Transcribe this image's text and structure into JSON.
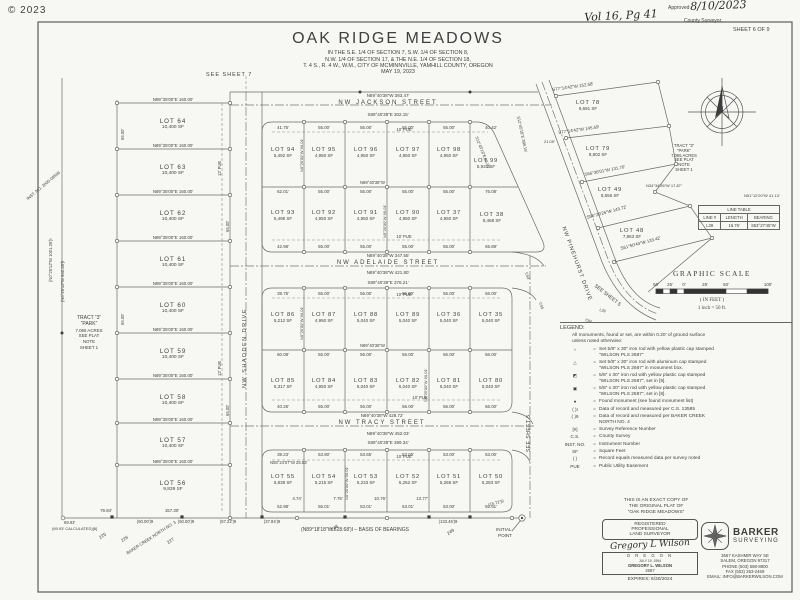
{
  "page": {
    "copyright": "© 2023",
    "sheet": "SHEET 6 OF 9"
  },
  "hand": {
    "vol": "Vol 16, Pg 41",
    "approved_label": "Approved",
    "date": "8/10/2023",
    "county": "County Surveyor"
  },
  "title_block": {
    "title": "OAK RIDGE MEADOWS",
    "l1": "IN THE S.E. 1/4 OF SECTION 7, S.W. 1/4 OF SECTION 8,",
    "l2": "N.W. 1/4 OF SECTION 17, & THE N.E. 1/4 OF SECTION 18,",
    "l3": "T. 4 S., R. 4 W., W.M., CITY OF MCMINNVILLE, YAMHILL  COUNTY, OREGON",
    "l4": "MAY 19, 2023"
  },
  "refs": {
    "sheet7": "SEE SHEET 7",
    "sheet5a": "SEE SHEET 5",
    "sheet5b": "SEE SHEET 5",
    "initial1": "INITIAL",
    "initial2": "POINT",
    "north_n": "N"
  },
  "streets": {
    "jackson": "NW JACKSON STREET",
    "adelaide": "NW ADELAIDE STREET",
    "tracy": "NW TRACY STREET",
    "shadden": "NW SHADDEN DRIVE",
    "pinehurst": "NW PINEHURST DRIVE"
  },
  "lots": [
    {
      "name": "LOT 64",
      "sf": "10,400 SF"
    },
    {
      "name": "LOT 63",
      "sf": "10,400 SF"
    },
    {
      "name": "LOT 62",
      "sf": "10,400 SF"
    },
    {
      "name": "LOT 61",
      "sf": "10,400 SF"
    },
    {
      "name": "LOT 60",
      "sf": "10,400 SF"
    },
    {
      "name": "LOT 59",
      "sf": "10,400 SF"
    },
    {
      "name": "LOT 58",
      "sf": "10,400 SF"
    },
    {
      "name": "LOT 57",
      "sf": "10,400 SF"
    },
    {
      "name": "LOT 56",
      "sf": "9,839 SF"
    },
    {
      "name": "LOT 94",
      "sf": "5,492 SF"
    },
    {
      "name": "LOT 95",
      "sf": "4,950 SF"
    },
    {
      "name": "LOT 96",
      "sf": "4,950 SF"
    },
    {
      "name": "LOT 97",
      "sf": "4,950 SF"
    },
    {
      "name": "LOT 98",
      "sf": "4,950 SF"
    },
    {
      "name": "LOT 99",
      "sf": "5,931 SF"
    },
    {
      "name": "LOT 93",
      "sf": "5,498 SF"
    },
    {
      "name": "LOT 92",
      "sf": "4,950 SF"
    },
    {
      "name": "LOT 91",
      "sf": "4,950 SF"
    },
    {
      "name": "LOT 90",
      "sf": "4,950 SF"
    },
    {
      "name": "LOT 37",
      "sf": "4,950 SF"
    },
    {
      "name": "LOT 38",
      "sf": "8,468 SF"
    },
    {
      "name": "LOT 86",
      "sf": "5,212 SF"
    },
    {
      "name": "LOT 87",
      "sf": "4,950 SF"
    },
    {
      "name": "LOT 88",
      "sf": "5,040 SF"
    },
    {
      "name": "LOT 89",
      "sf": "5,040 SF"
    },
    {
      "name": "LOT 36",
      "sf": "5,040 SF"
    },
    {
      "name": "LOT 35",
      "sf": "5,040 SF"
    },
    {
      "name": "LOT 85",
      "sf": "5,317 SF"
    },
    {
      "name": "LOT 84",
      "sf": "4,950 SF"
    },
    {
      "name": "LOT 83",
      "sf": "5,040 SF"
    },
    {
      "name": "LOT 82",
      "sf": "5,040 SF"
    },
    {
      "name": "LOT 81",
      "sf": "5,040 SF"
    },
    {
      "name": "LOT 80",
      "sf": "5,040 SF"
    },
    {
      "name": "LOT 55",
      "sf": "5,838 SF"
    },
    {
      "name": "LOT 54",
      "sf": "5,215 SF"
    },
    {
      "name": "LOT 53",
      "sf": "5,233 SF"
    },
    {
      "name": "LOT 52",
      "sf": "5,252 SF"
    },
    {
      "name": "LOT 51",
      "sf": "5,269 SF"
    },
    {
      "name": "LOT 50",
      "sf": "5,283 SF"
    },
    {
      "name": "LOT 78",
      "sf": "9,691 SF"
    },
    {
      "name": "LOT 79",
      "sf": "8,802 SF"
    },
    {
      "name": "LOT 49",
      "sf": "8,556 SF"
    },
    {
      "name": "LOT 48",
      "sf": "7,863 SF"
    }
  ],
  "tract": {
    "t1": "TRACT “3”",
    "t2": "“PARK”",
    "t3": "7.065 ACRES",
    "t4": "SEE PLAT",
    "t5": "NOTE",
    "t6": "SHEET 1"
  },
  "bearings": {
    "jackson_out": "N89°40′38″W 383.47′",
    "jackson_in": "S89°40′38″E 302.15′",
    "adelaide_out1": "N89°40′38″W 347.55′",
    "adelaide_out2": "N89°40′38″W 421.80′",
    "adelaide_in": "S89°40′38″E 376.21′",
    "tracy_out1": "N89°40′38″W 428.72′",
    "tracy_out2": "N89°40′38″W 452.03′",
    "tracy_in": "S89°40′38″E 399.34′",
    "mid_ab": "N89°40′38″W",
    "row160": "N89°35′00″E 160.00′",
    "side65": "65.00′",
    "side90": "N0°25′00″W 90.01′",
    "d78": "S77°14′42″W 152.58′",
    "d79": "S77°14′42″W 145.59′",
    "d49": "S66°36′01″W 131.70′",
    "d48": "S56°29′26″W 143.72′",
    "d48b": "S61°50′43″W 133.42′",
    "e99": "S12°45′18″E 36.99′",
    "e21": "21.05′",
    "n34": "N34°34′26″W 17.87′",
    "n51": "N51°12′20″W 41.13′",
    "s12": "S12°45′18″E 389.15′",
    "n08": "N08°24′07″W 25.53′",
    "w1001": "(N0°25′12″W 1001.26′)I",
    "w942": "(N0°25′12″W 942.28′)I",
    "inst": "INST. NO. 2000-09569"
  },
  "dims": {
    "wA_top": [
      "41.75′",
      "55.00′",
      "55.00′",
      "55.00′",
      "55.00′",
      "40.42′"
    ],
    "wA_mid": [
      "62.01′",
      "55.00′",
      "55.00′",
      "55.00′",
      "55.00′",
      "76.08′"
    ],
    "wA_bot": [
      "42.98′",
      "55.00′",
      "55.00′",
      "55.00′",
      "55.00′",
      "65.89′"
    ],
    "wB_top": [
      "39.75′",
      "55.00′",
      "56.00′",
      "56.00′",
      "56.00′",
      "56.00′"
    ],
    "wB_mid": [
      "60.08′",
      "55.00′",
      "56.00′",
      "56.00′",
      "56.00′",
      "56.00′"
    ],
    "wB_bot": [
      "40.26′",
      "55.00′",
      "56.00′",
      "56.00′",
      "56.00′",
      "56.00′"
    ],
    "wC_top": [
      "39.23′",
      "53.80′",
      "53.65′",
      "53.05′",
      "53.00′",
      "53.00′"
    ],
    "wC_bot": [
      "52.98′",
      "55.01′",
      "53.01′",
      "53.01′",
      "53.00′",
      "92.91′"
    ],
    "stubs": [
      "4.74′",
      "7.75′",
      "10.76′",
      "13.77′"
    ]
  },
  "bottom": {
    "d7984": "79.84′",
    "d6993": "69.93′",
    "calc": "(69.93′ CALCULATED)[8]",
    "d15730": "157.30′",
    "r50a": "(50.00′)9",
    "r50b": "(50.00′)9",
    "r5722": "(57.22′)9",
    "r3784": "(37.84′)9",
    "r13346": "(133.46′)9",
    "r1572": "(15.72′)9",
    "basis": "(N89°18′18″W 628.68′)I  –  BASIS OF BEARINGS"
  },
  "adjacent": {
    "n225": "225",
    "n226": "226",
    "n227": "227",
    "n248": "248",
    "n249": "249",
    "plat": "BAKER CREEK NORTH NO. 3"
  },
  "curves": {
    "c53": "C53",
    "c55": "C55",
    "c60": "C60",
    "l39": "L39"
  },
  "pue": {
    "p10": "10′ PUE",
    "p12": "12′ PUE"
  },
  "scale": {
    "title": "GRAPHIC SCALE",
    "t1": "50′",
    "t2": "25′",
    "t3": "0′",
    "t4": "25′",
    "t5": "50′",
    "t6": "100′",
    "feet": "( IN FEET )",
    "ratio": "1 inch = 50 ft."
  },
  "line_table": {
    "title": "LINE TABLE",
    "h1": "LINE #",
    "h2": "LENGTH",
    "h3": "BEARING",
    "r1": "L39",
    "r2": "16.76′",
    "r3": "S53°27′45″W"
  },
  "legend": {
    "title": "LEGEND:",
    "note1": "All monuments, found or set, are within 0.20′ of ground surface",
    "note2": "unless noted otherwise:",
    "eq": "=",
    "items": [
      {
        "sym": "○",
        "t1": "Set 5/8″ x 30″ iron rod with yellow plastic cap stamped",
        "t2": "“WILSON PLS 2687”"
      },
      {
        "sym": "△",
        "t1": "Set 5/8″ x 30″ iron rod with aluminum cap stamped",
        "t2": "“WILSON PLS 2687” in monument box."
      },
      {
        "sym": "◩",
        "t1": "5/8″ x 30″ iron rod with yellow plastic cap stamped",
        "t2": "“WILSON PLS 2687”, set in [9]."
      },
      {
        "sym": "▣",
        "t1": "5/8″ x 30″ iron rod with yellow plastic cap stamped",
        "t2": "“WILSON PLS 2687”, set in [8]."
      },
      {
        "sym": "●",
        "t1": "Found monument (see found monument list)",
        "t2": ""
      },
      {
        "sym": "(  )I",
        "t1": "Data of record and measured per C.S. 13585",
        "t2": ""
      },
      {
        "sym": "(  )9",
        "t1": "Data of record and measured per BAKER CREEK",
        "t2": "NORTH NO. 4"
      },
      {
        "sym": "[#]",
        "t1": "Survey Reference Number",
        "t2": ""
      },
      {
        "sym": "C.S.",
        "t1": "County Survey",
        "t2": ""
      },
      {
        "sym": "INST. NO.",
        "t1": "Instrument Number",
        "t2": ""
      },
      {
        "sym": "SF",
        "t1": "Square Feet",
        "t2": ""
      },
      {
        "sym": "(  )",
        "t1": "Record equals measured data per survey noted",
        "t2": ""
      },
      {
        "sym": "PUE",
        "t1": "Public Utility Easement",
        "t2": ""
      }
    ]
  },
  "copy_note": {
    "l1": "THIS IS AN EXACT COPY OF",
    "l2": "THE ORIGINAL PLAT OF",
    "l3": "“OAK RIDGE MEADOWS”"
  },
  "stamp": {
    "l1": "REGISTERED",
    "l2": "PROFESSIONAL",
    "l3": "LAND SURVEYOR",
    "sig": "Gregory L Wilson",
    "state": "O R E G O N",
    "date": "JULY 19, 1994",
    "name": "GREGORY L. WILSON",
    "num": "2687",
    "exp": "EXPIRES: 6/30/2024"
  },
  "firm": {
    "n1": "BARKER",
    "n2": "SURVEYING",
    "a1": "3657 KASHMIR WAY SE",
    "a2": "SALEM, OREGON 97317",
    "a3": "PHONE (503) 588-8800",
    "a4": "FAX (503) 363-2469",
    "a5": "EMAIL: INFO@BARKERWILSON.COM"
  }
}
